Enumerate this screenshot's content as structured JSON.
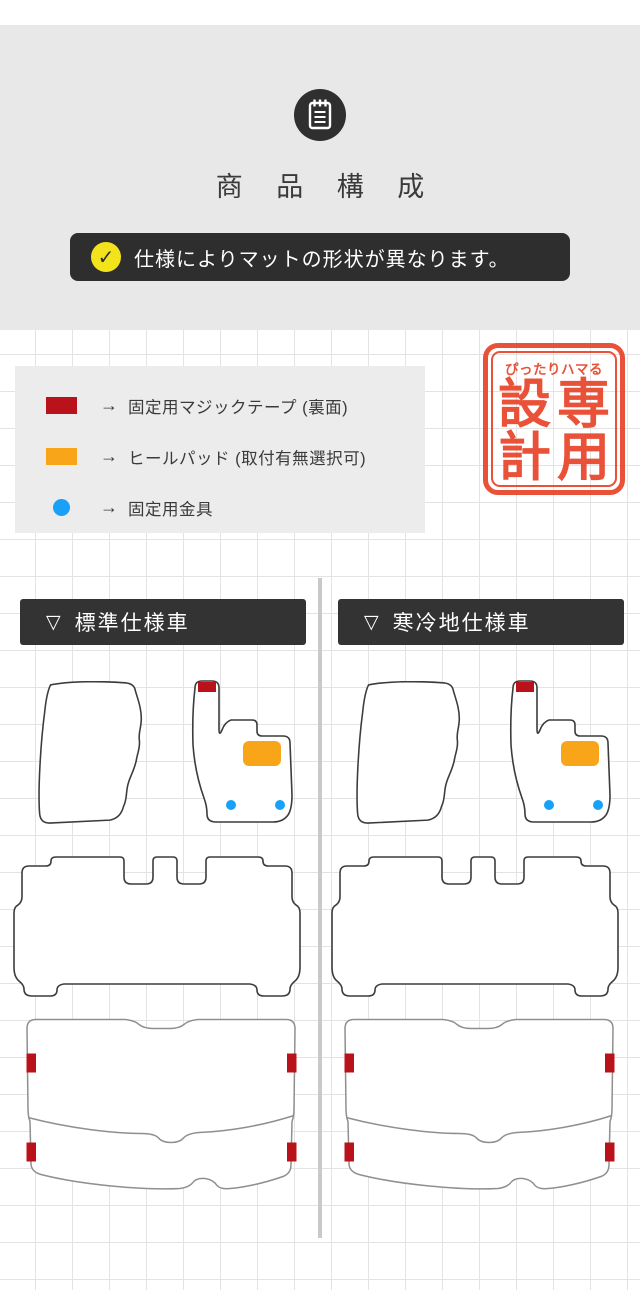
{
  "colors": {
    "gray_panel": "#e8e8e8",
    "dark": "#333333",
    "badge_bg": "#2e2e2e",
    "yellow": "#f2e31c",
    "red": "#b9121b",
    "orange": "#f9a51a",
    "blue": "#19a0f8",
    "stamp": "#e8492e",
    "grid_line": "#e3e3e3",
    "legend_bg": "#ececec",
    "divider": "#c9c9c9",
    "outline": "#3c3c3c",
    "trunk_outline": "#8f8f8f",
    "text": "#3a3a3a",
    "white": "#ffffff"
  },
  "header": {
    "icon": "notepad-icon",
    "title": "商品構成",
    "title_spaced": "商 品 構 成"
  },
  "notice": {
    "check_mark": "✓",
    "text": "仕様によりマットの形状が異なります。"
  },
  "legend": {
    "arrow": "→",
    "items": [
      {
        "swatch": "red-rectangle",
        "label": "固定用マジックテープ (裏面)"
      },
      {
        "swatch": "orange-rectangle",
        "label": "ヒールパッド (取付有無選択可)"
      },
      {
        "swatch": "blue-dot",
        "label": "固定用金具"
      }
    ]
  },
  "stamp": {
    "top_text": "ぴったりハマる",
    "main_text": "専用設計",
    "chars": {
      "left_top": "設",
      "right_top": "専",
      "left_bottom": "計",
      "right_bottom": "用"
    }
  },
  "columns": [
    {
      "marker": "▽",
      "label": "標準仕様車"
    },
    {
      "marker": "▽",
      "label": "寒冷地仕様車"
    }
  ],
  "mats": {
    "front_passenger": "助手席マット",
    "front_driver": "運転席マット",
    "second_row": "セカンドマット",
    "trunk": "ラゲッジマット"
  }
}
